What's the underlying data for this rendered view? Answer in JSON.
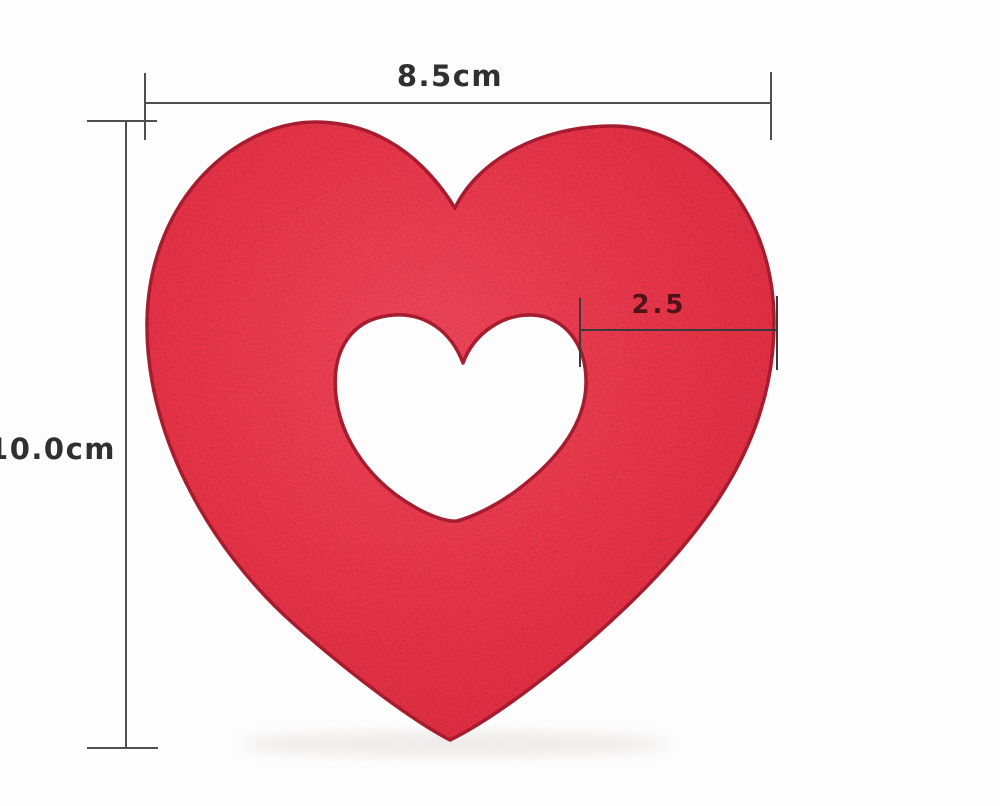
{
  "scene": {
    "description": "Red heart-shaped sponge with a heart-shaped cutout in the center, shown on a white background with measurement annotations",
    "background_color": "#fdfdfd",
    "product": {
      "kind": "heart-sponge-with-heart-cutout",
      "fill_center": "#f0465a",
      "fill_mid": "#e73347",
      "fill_edge": "#da2a3e",
      "outline_color": "#a81d30",
      "shadow_color": "#ddd5d2",
      "hole_fill": "#fdfdfd"
    },
    "annotations": {
      "line_color": "#4f4f4f",
      "inner_line_color": "#3a3a3a",
      "label_color": "#303030",
      "inner_label_color": "#4e1318",
      "width": {
        "label": "8.5cm"
      },
      "height": {
        "label": "10.0cm"
      },
      "hole": {
        "label": "2.5"
      }
    }
  }
}
